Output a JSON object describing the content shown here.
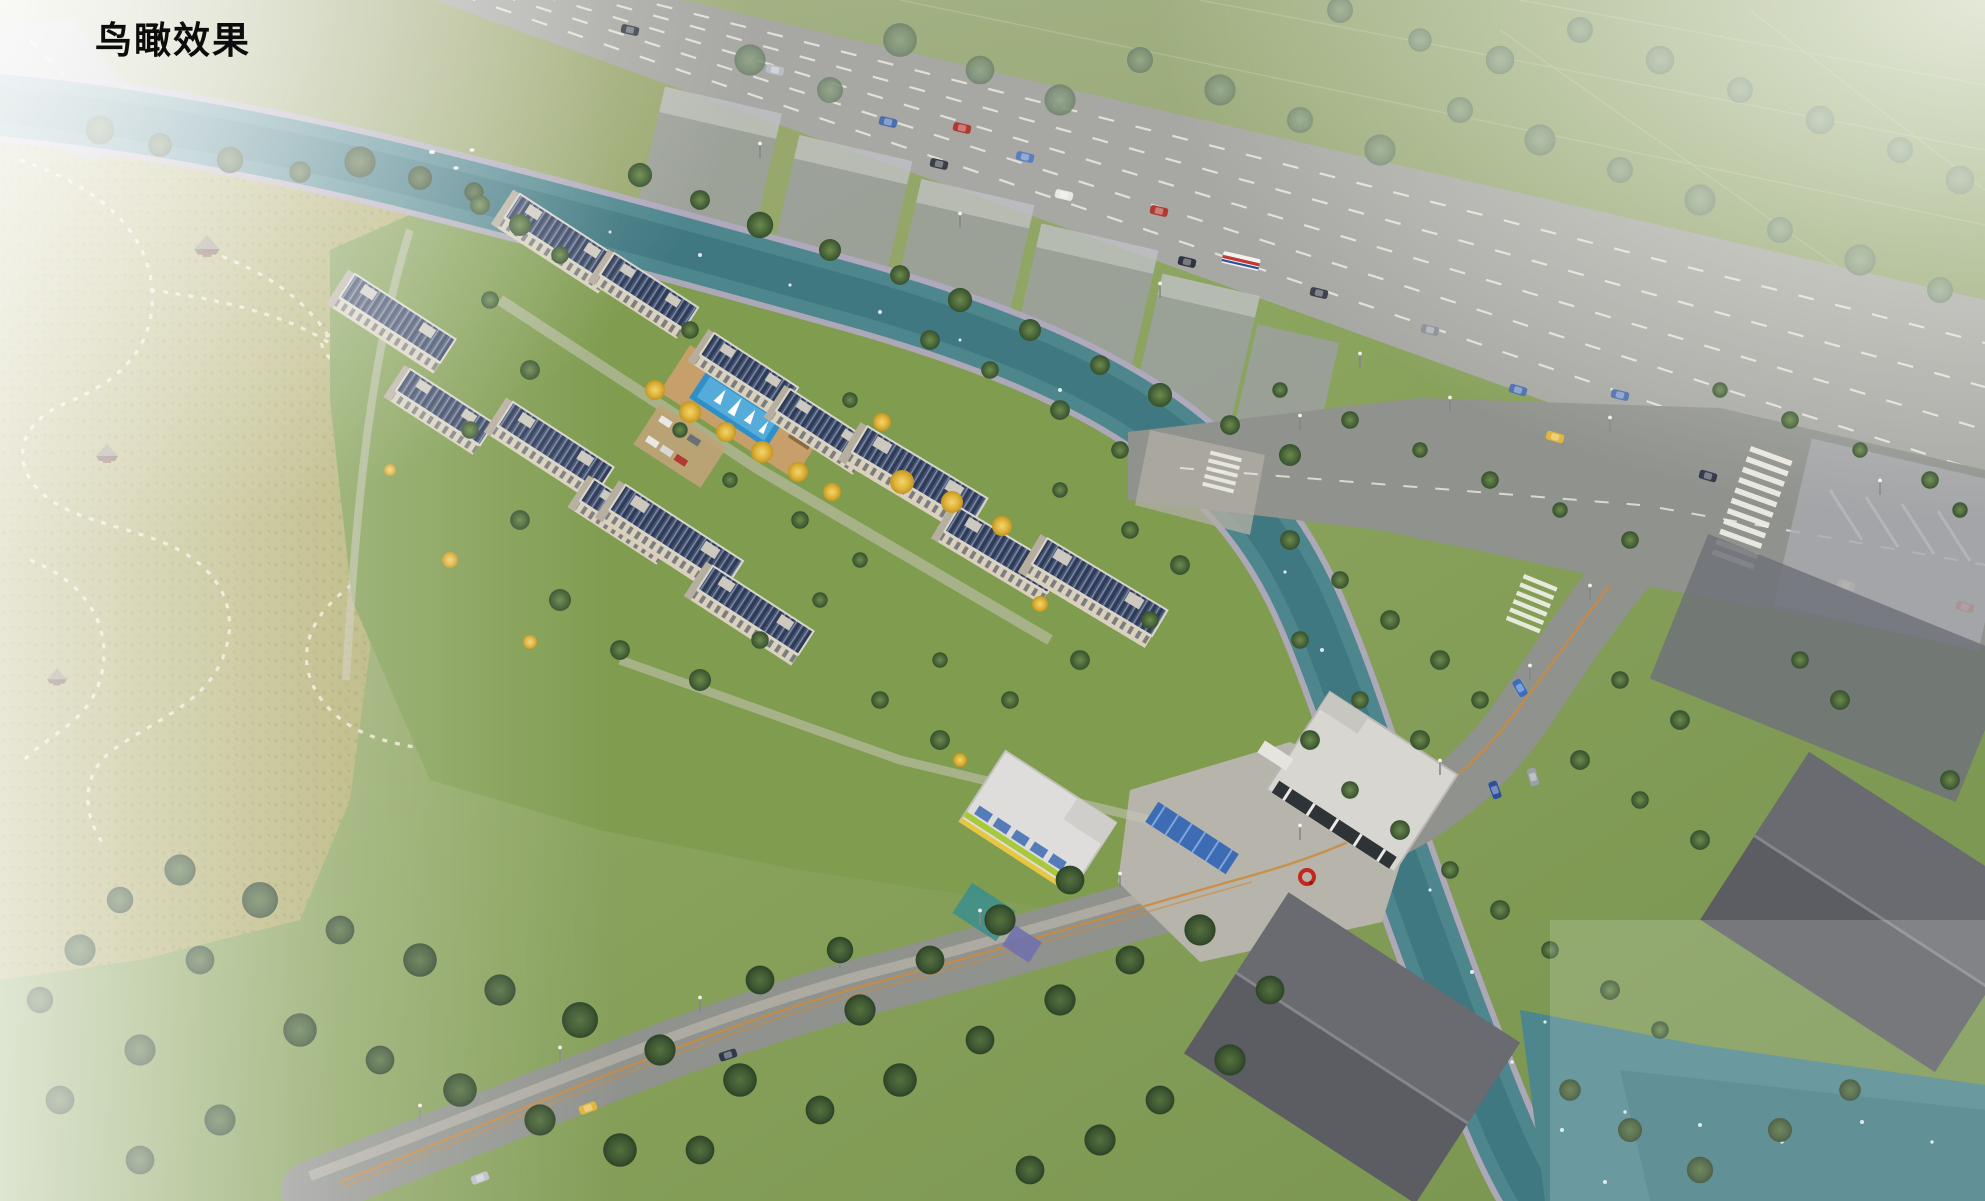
{
  "page": {
    "title": "鸟瞰效果"
  },
  "scene": {
    "colors": {
      "water": "#4e868e",
      "water_deep": "#356d77",
      "river_bank": "#b3aac2",
      "park": "#b2ad6e",
      "lawn": "#7f9c4f",
      "fields": "#9fae7c",
      "tree_green": "#42603a",
      "tree_gold": "#e0b33c",
      "tree_hazy": "#7d9178",
      "solar_roof": "#46536e",
      "roof_trim": "#d9d6cd",
      "facade": "#d9d1bd",
      "highway": "#a7a8a3",
      "road": "#90928d",
      "plaza": "#b7b5ab",
      "massing": "#9fa0a6",
      "context_house": "#5c5d62",
      "kinder_green": "#a9c93d",
      "kinder_yellow": "#e9c63f",
      "kinder_blue": "#3d6cb4",
      "pool": "#2f8fc9",
      "deck": "#c79f6a",
      "sculpture": "#c4271d",
      "lane_mark": "#eceae2",
      "center_line": "#cc8a3c",
      "path_dash": "#ece5cc",
      "fog": "#ffffff"
    }
  }
}
